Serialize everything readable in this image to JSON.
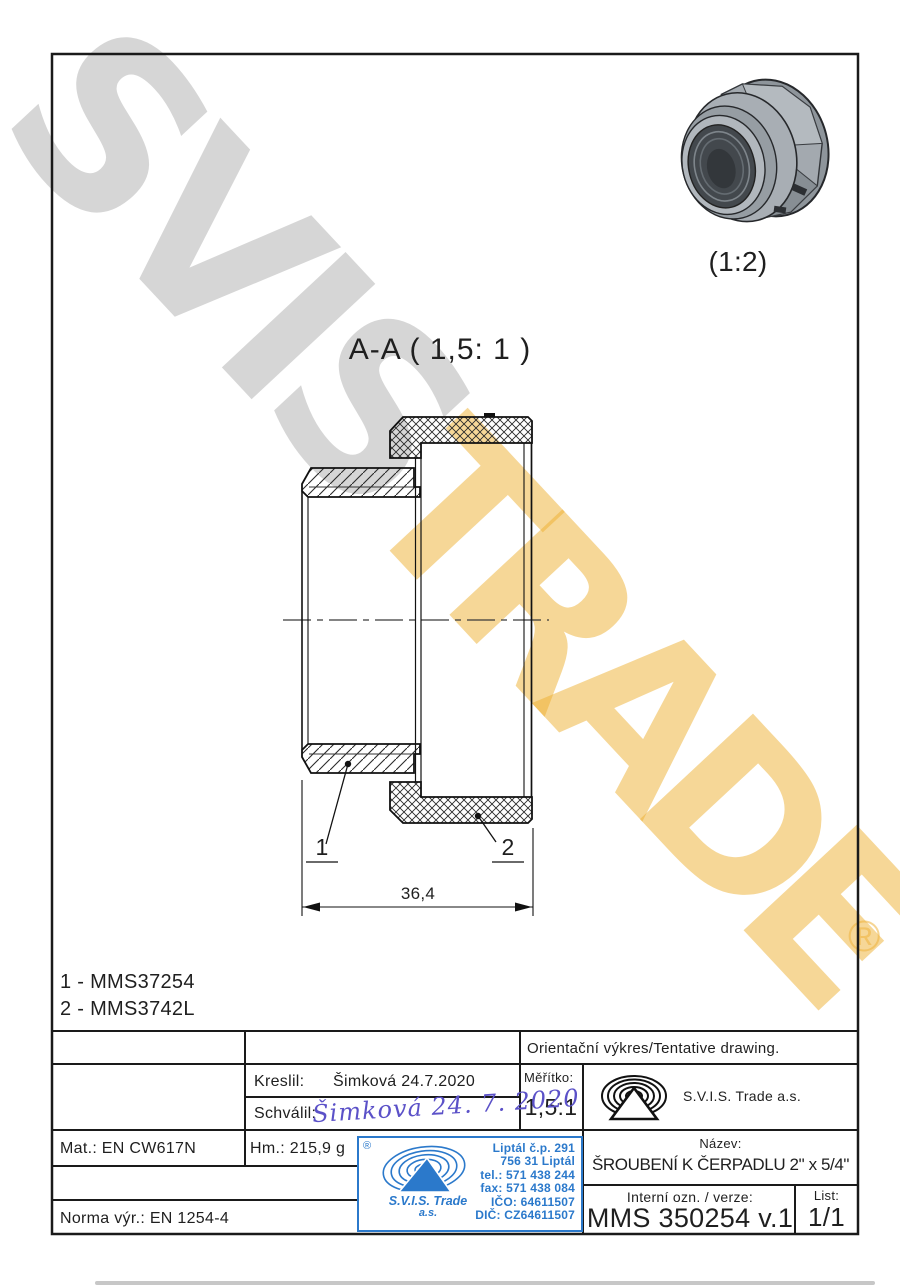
{
  "watermark": {
    "word_gray": "SVIS",
    "word_yellow": "TRADE",
    "registered": "®",
    "gray_color": "#d9d9d9",
    "yellow_color": "#eeb030"
  },
  "view_3d": {
    "scale_label": "(1:2)"
  },
  "section_view": {
    "title": "A-A ( 1,5: 1 )",
    "dimension_width": "36,4",
    "callout_1": "1",
    "callout_2": "2"
  },
  "parts_list": [
    {
      "text": "1 - MMS37254"
    },
    {
      "text": "2 - MMS3742L"
    }
  ],
  "title_block": {
    "orientation_note": "Orientační výkres/Tentative drawing.",
    "drawn_label": "Kreslil:",
    "drawn_value": "Šimková 24.7.2020",
    "approved_label": "Schválil:",
    "approved_signature": "Šimková 24. 7. 2020",
    "scale_label": "Měřítko:",
    "scale_value": "1,5:1",
    "company_name": "S.V.I.S. Trade a.s.",
    "name_label": "Název:",
    "name_value": "ŠROUBENÍ K ČERPADLU 2\" x 5/4\"",
    "internal_label": "Interní ozn. / verze:",
    "internal_value": "MMS 350254 v.1",
    "sheet_label": "List:",
    "sheet_value": "1/1",
    "material": "Mat.: EN CW617N",
    "weight": "Hm.: 215,9 g",
    "standard": "Norma výr.: EN 1254-4"
  },
  "stamp": {
    "registered": "®",
    "company_line1": "S.V.I.S. Trade",
    "company_line2": "a.s.",
    "address_lines": [
      "Liptál č.p. 291",
      "756 31 Liptál",
      "tel.: 571 438 244",
      "fax: 571 438 084",
      "IČO: 64611507",
      "DIČ: CZ64611507"
    ],
    "blue": "#2b79cb"
  },
  "colors": {
    "ink": "#1a1a1a",
    "signature_blue": "#5b51c8"
  }
}
